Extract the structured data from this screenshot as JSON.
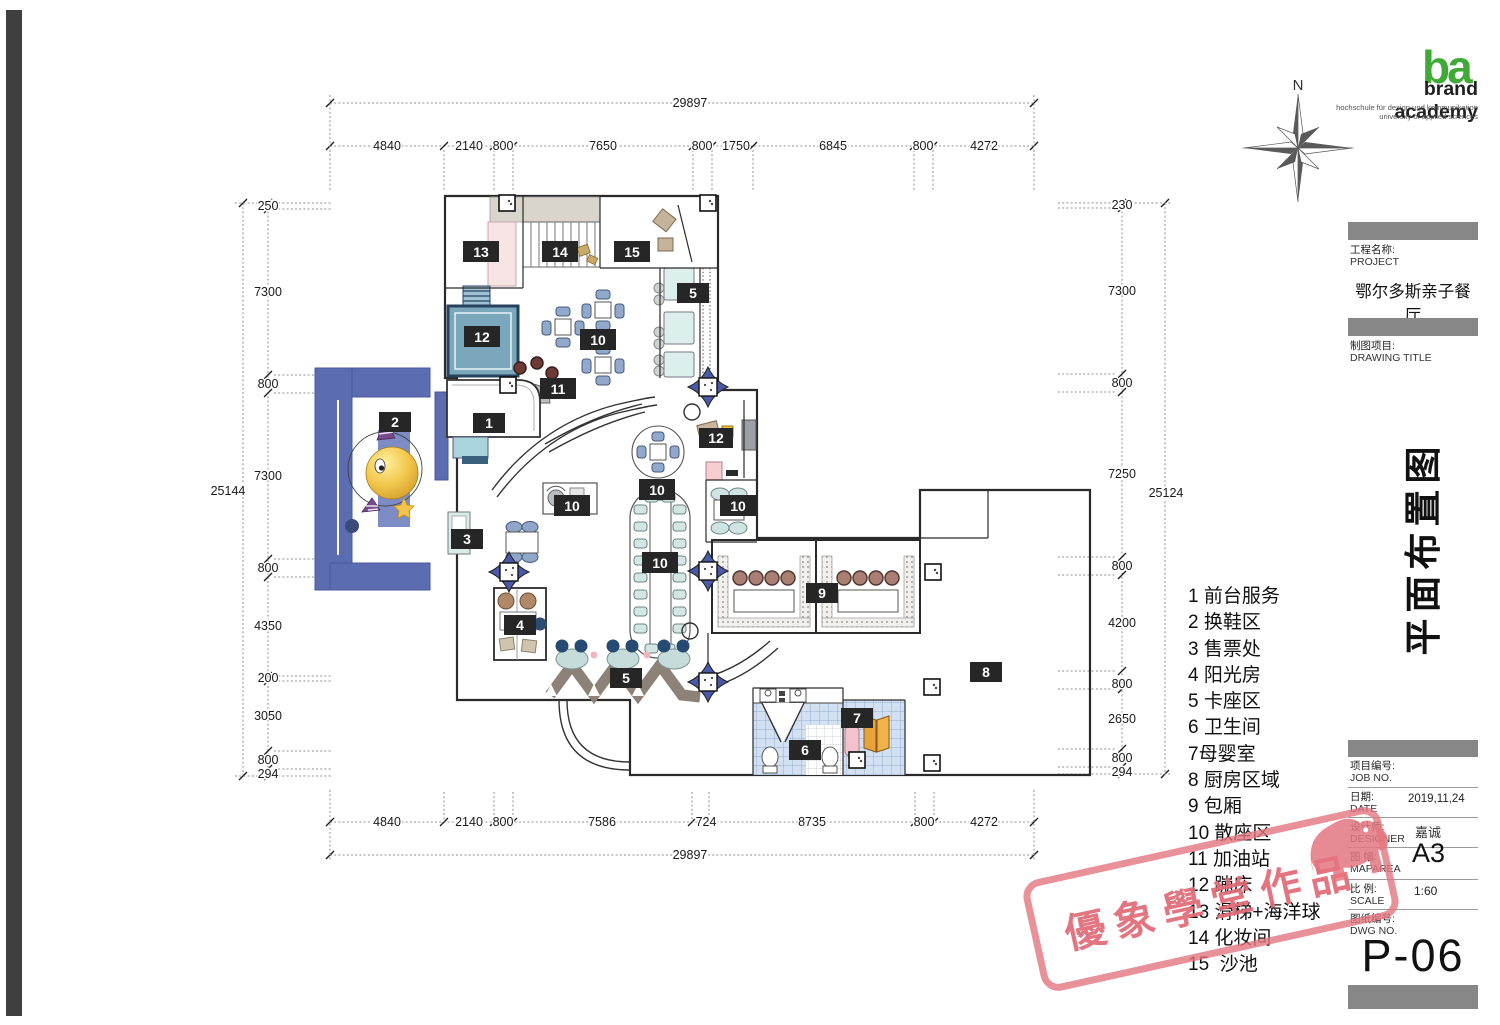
{
  "branding": {
    "glyph": "ba",
    "name": "brand academy",
    "tagline1": "hochschule für design und kommunikation",
    "tagline2": "university of applied sciences"
  },
  "compass": {
    "north": "N"
  },
  "title_block": {
    "project_label_cn": "工程名称:",
    "project_label_en": "PROJECT",
    "project_name": "鄂尔多斯亲子餐厅",
    "drawing_label_cn": "制图项目:",
    "drawing_label_en": "DRAWING TITLE",
    "drawing_title": "平面布置图",
    "job_no_cn": "项目编号:",
    "job_no_en": "JOB NO.",
    "date_cn": "日期:",
    "date_en": "DATE",
    "date_value": "2019,11,24",
    "designer_cn": "设计师:",
    "designer_en": "DESIGNER",
    "designer_value": "嘉诚",
    "maparea_cn": "图 幅:",
    "maparea_en": "MAPAREA",
    "maparea_value": "A3",
    "scale_cn": "比 例:",
    "scale_en": "SCALE",
    "scale_value": "1:60",
    "dwg_cn": "图纸编号:",
    "dwg_en": "DWG NO.",
    "dwg_value": "P-06"
  },
  "legend": {
    "items": [
      "1 前台服务",
      "2 换鞋区",
      "3 售票处",
      "4 阳光房",
      "5 卡座区",
      "6 卫生间",
      "7母婴室",
      "8 厨房区域",
      "9 包厢",
      "10 散座区",
      "11 加油站",
      "12 蹦床",
      "13 滑梯+海洋球",
      "14 化妆间",
      "15  沙池"
    ]
  },
  "watermark": {
    "text": "優象學堂作品"
  },
  "dims": {
    "top_total": "29897",
    "top_segments": [
      "4840",
      "2140",
      "800",
      "7650",
      "800",
      "1750",
      "6845",
      "800",
      "4272"
    ],
    "bottom_total": "29897",
    "bottom_segments": [
      "4840",
      "2140",
      "800",
      "7586",
      "724",
      "8735",
      "800",
      "4272"
    ],
    "left_total": "25144",
    "left_segments": [
      "250",
      "7300",
      "800",
      "7300",
      "800",
      "4350",
      "200",
      "3050",
      "800",
      "294"
    ],
    "right_total": "25124",
    "right_segments": [
      "230",
      "7300",
      "800",
      "7250",
      "800",
      "4200",
      "800",
      "2650",
      "800",
      "294"
    ]
  },
  "plan": {
    "labels": [
      "13",
      "14",
      "15",
      "5",
      "12",
      "10",
      "11",
      "2",
      "1",
      "12",
      "10",
      "10",
      "10",
      "3",
      "10",
      "9",
      "4",
      "8",
      "5",
      "7",
      "6"
    ]
  },
  "colors": {
    "stamp_pink": "#e2737e",
    "logo_green": "#3faa36",
    "pillar_blue": "#4a5aa8",
    "entrance_blue": "#5b6cb0",
    "trampoline_blue": "#7ba7bd",
    "booth_teal": "#d9ece9",
    "chair_blue": "#93a9cc",
    "tile_blue": "#d3e0f2",
    "door_orange": "#e8a33c",
    "ball_yellow": "#f2c64b"
  }
}
